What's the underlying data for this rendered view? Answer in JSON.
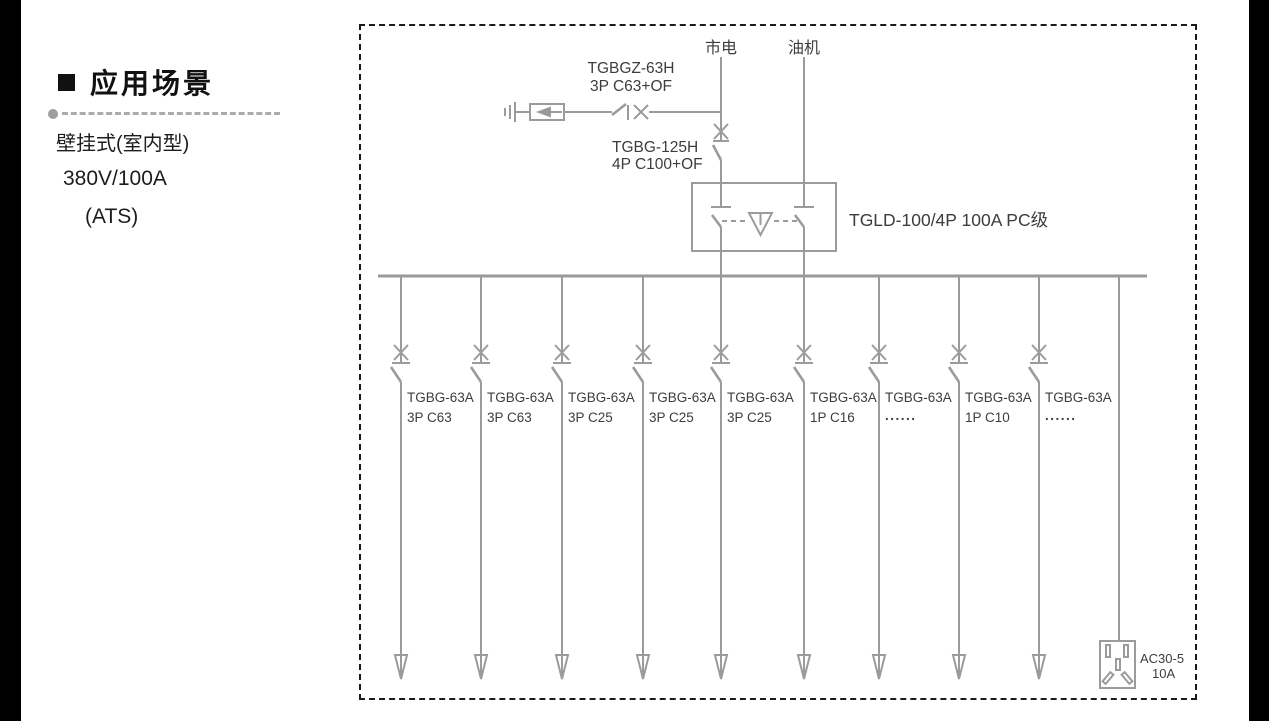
{
  "sidebar": {
    "bullet_icon": "black-square",
    "heading": "应用场景",
    "spec_lines": [
      "壁挂式(室内型)",
      "380V/100A",
      "(ATS)"
    ]
  },
  "diagram": {
    "colors": {
      "line_gray": "#9b9b9b",
      "text_dark": "#3d3d3d",
      "border_black": "#1b1b1b"
    },
    "sources": {
      "mains": "市电",
      "generator": "油机"
    },
    "surge_breaker_label": {
      "line1": "TGBGZ-63H",
      "line2": "3P C63+OF"
    },
    "main_breaker_label": {
      "line1": "TGBG-125H",
      "line2": "4P C100+OF"
    },
    "ats_label": "TGLD-100/4P 100A PC级",
    "branches": [
      {
        "line1": "TGBG-63A",
        "line2": "3P C63"
      },
      {
        "line1": "TGBG-63A",
        "line2": "3P C63"
      },
      {
        "line1": "TGBG-63A",
        "line2": "3P C25"
      },
      {
        "line1": "TGBG-63A",
        "line2": "3P C25"
      },
      {
        "line1": "TGBG-63A",
        "line2": "3P C25"
      },
      {
        "line1": "TGBG-63A",
        "line2": "1P C16"
      },
      {
        "line1": "TGBG-63A",
        "line2": "......"
      },
      {
        "line1": "TGBG-63A",
        "line2": "1P C10"
      },
      {
        "line1": "TGBG-63A",
        "line2": "......"
      }
    ],
    "socket_label": {
      "line1": "AC30-5",
      "line2": "10A"
    }
  }
}
